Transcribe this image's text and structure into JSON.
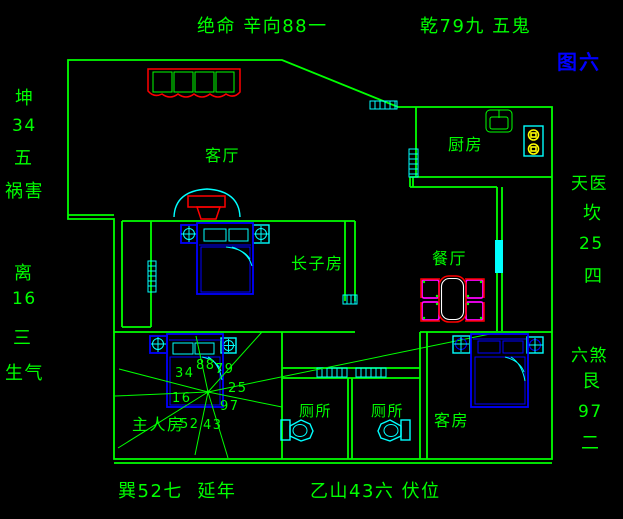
{
  "canvas": {
    "bg": "#000000"
  },
  "colors": {
    "bg": "#000000",
    "green": "#00ff00",
    "cyan": "#00ffff",
    "blue": "#0000ff",
    "red": "#ff0000",
    "magenta": "#ff00ff",
    "yellow": "#ffff00",
    "white": "#ffffff"
  },
  "annotations": {
    "top_left": "绝命 辛向88一",
    "top_right": "乾79九 五鬼",
    "figure_label": "图六",
    "left_upper": [
      "坤",
      "34",
      "五",
      "祸害"
    ],
    "left_lower": [
      "离",
      "16",
      "三",
      "生气"
    ],
    "right_upper": [
      "天医",
      "坎",
      "25",
      "四"
    ],
    "right_lower": [
      "六煞",
      "艮",
      "97",
      "二"
    ],
    "bottom_left": "巽52七  延年",
    "bottom_right": "乙山43六 伏位"
  },
  "rooms": [
    {
      "id": "living-room",
      "label": "客厅"
    },
    {
      "id": "kitchen",
      "label": "厨房"
    },
    {
      "id": "dining-room",
      "label": "餐厅"
    },
    {
      "id": "eldest-son-room",
      "label": "长子房"
    },
    {
      "id": "master-room",
      "label": "主人房"
    },
    {
      "id": "toilet-left",
      "label": "厕所"
    },
    {
      "id": "toilet-right",
      "label": "厕所"
    },
    {
      "id": "guest-room",
      "label": "客房"
    }
  ],
  "compass": {
    "numbers": [
      "88",
      "79",
      "34",
      "25",
      "16",
      "97",
      "52",
      "43"
    ]
  }
}
